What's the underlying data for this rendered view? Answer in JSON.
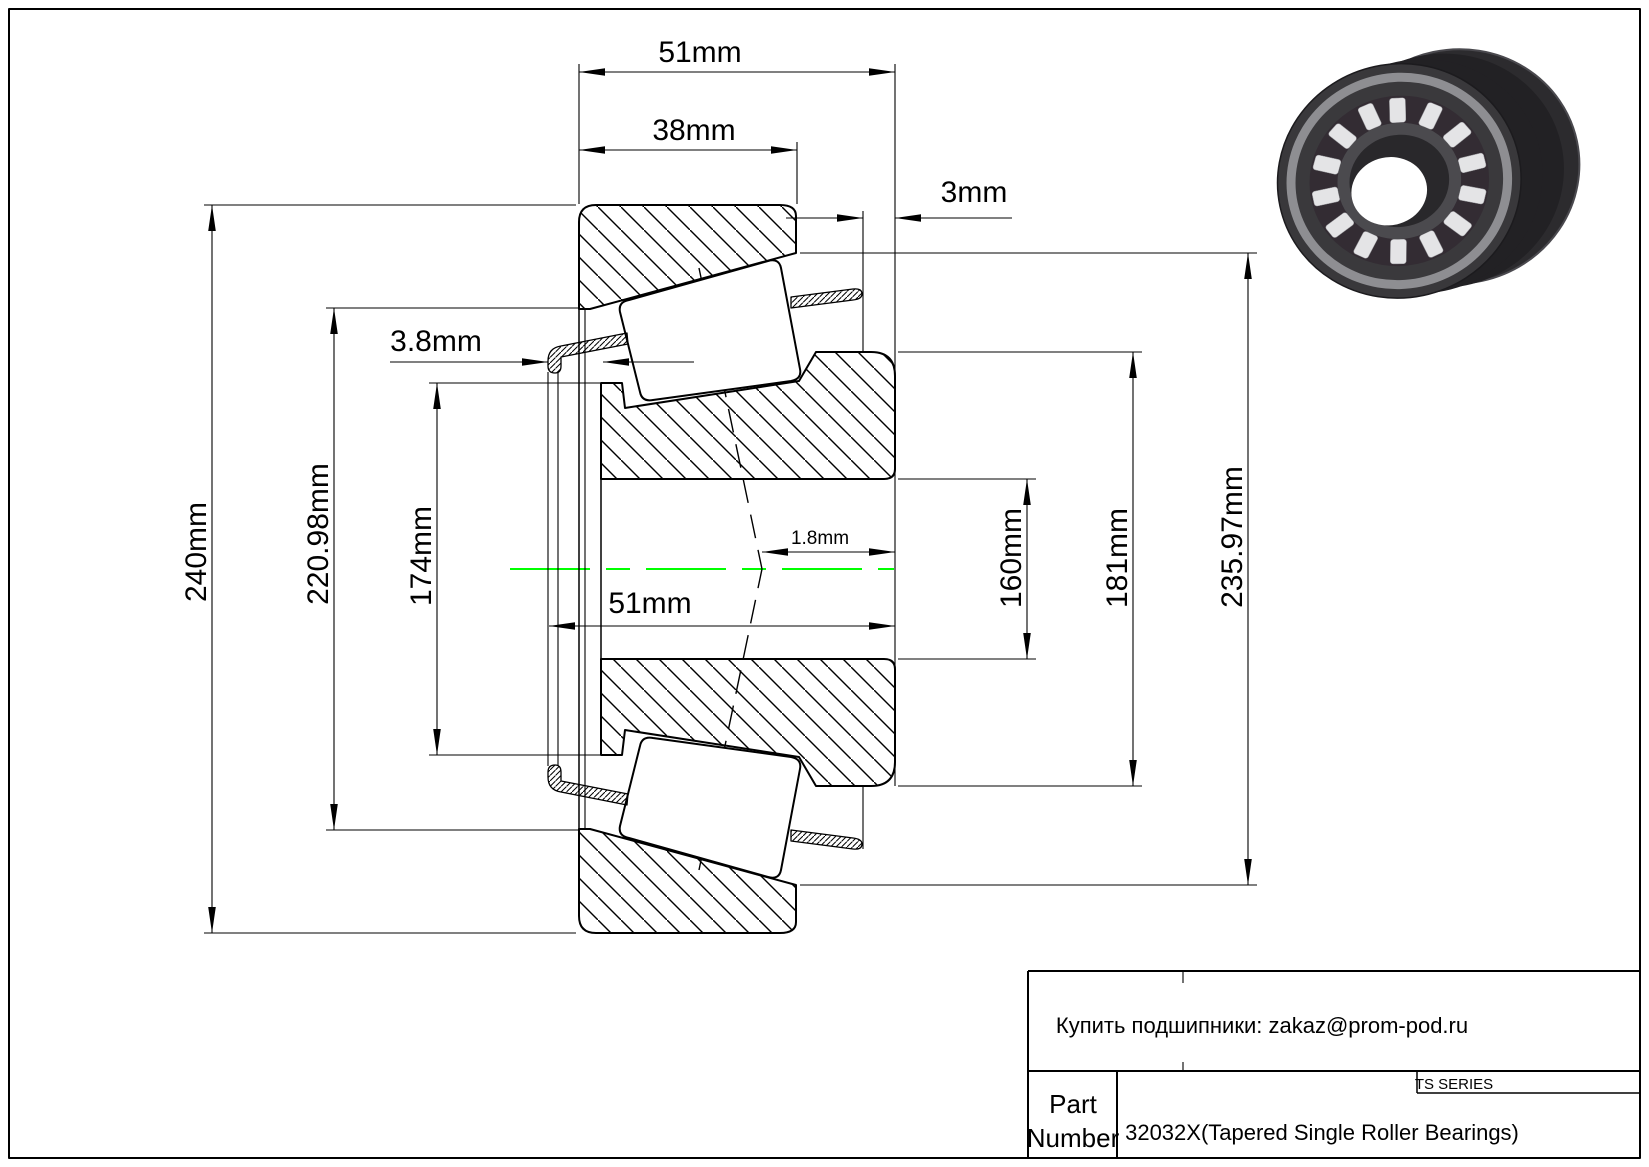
{
  "dimensions": {
    "overall_width_top": "51mm",
    "cup_width": "38mm",
    "cage_overhang_back": "3mm",
    "cage_overhang_front": "3.8mm",
    "cone_width": "51mm",
    "effective_center_offset": "1.8mm",
    "outside_diameter": "240mm",
    "cup_raceway_diameter": "220.98mm",
    "cone_front_rib_diameter": "174mm",
    "bore_diameter": "160mm",
    "cone_back_rib_diameter": "181mm",
    "cup_back_raceway_diameter": "235.97mm"
  },
  "title_block": {
    "contact_line": "Купить подшипники: zakaz@prom-pod.ru",
    "series_label": "TS SERIES",
    "part_label_line1": "Part",
    "part_label_line2": "Number",
    "part_value": "32032X(Tapered Single Roller Bearings)"
  },
  "colors": {
    "background": "#FFFFFF",
    "line": "#000000",
    "centerline": "#00FF00",
    "render_body": "#2A292C",
    "render_rollers": "#E4E4E6"
  }
}
